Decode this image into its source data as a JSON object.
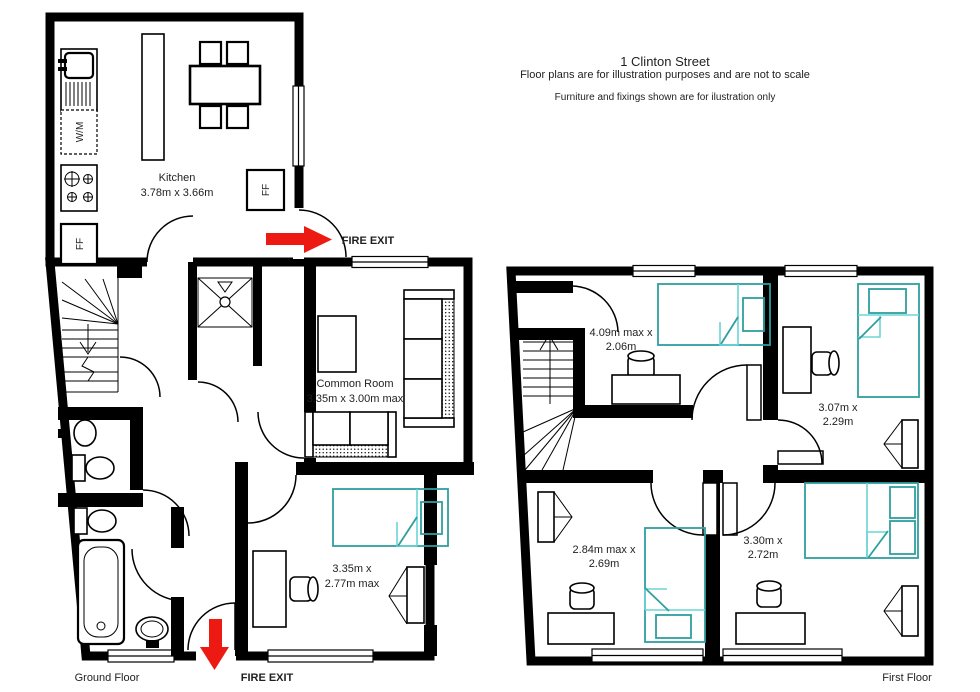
{
  "header": {
    "title": "1 Clinton Street",
    "subtitle": "Floor plans are for illustration purposes and are not to scale",
    "note": "Furniture and fixings shown are for ilustration only"
  },
  "ground_floor": {
    "floor_label": "Ground Floor",
    "kitchen": {
      "name": "Kitchen",
      "dims": "3.78m x 3.66m"
    },
    "common_room": {
      "name": "Common Room",
      "dims": "3.35m x 3.00m max"
    },
    "bedroom": {
      "dims_line1": "3.35m x",
      "dims_line2": "2.77m max"
    },
    "appliances": {
      "washing_machine": "W/M",
      "fridge_freezer_1": "FF",
      "fridge_freezer_2": "FF"
    },
    "fire_exit_side": "FIRE EXIT",
    "fire_exit_front": "FIRE EXIT"
  },
  "first_floor": {
    "floor_label": "First Floor",
    "bedroom_1": {
      "dims_line1": "4.09m max x",
      "dims_line2": "2.06m"
    },
    "bedroom_2": {
      "dims_line1": "3.07m x",
      "dims_line2": "2.29m"
    },
    "bedroom_3": {
      "dims_line1": "2.84m max x",
      "dims_line2": "2.69m"
    },
    "bedroom_4": {
      "dims_line1": "3.30m x",
      "dims_line2": "2.72m"
    }
  },
  "colors": {
    "wall": "#000000",
    "bed_outline": "#2f9e9e",
    "bed_fold": "#6bd6d6",
    "fire_arrow_red": "#ec1a13",
    "label_text": "#1f1f1f",
    "background": "#ffffff"
  }
}
